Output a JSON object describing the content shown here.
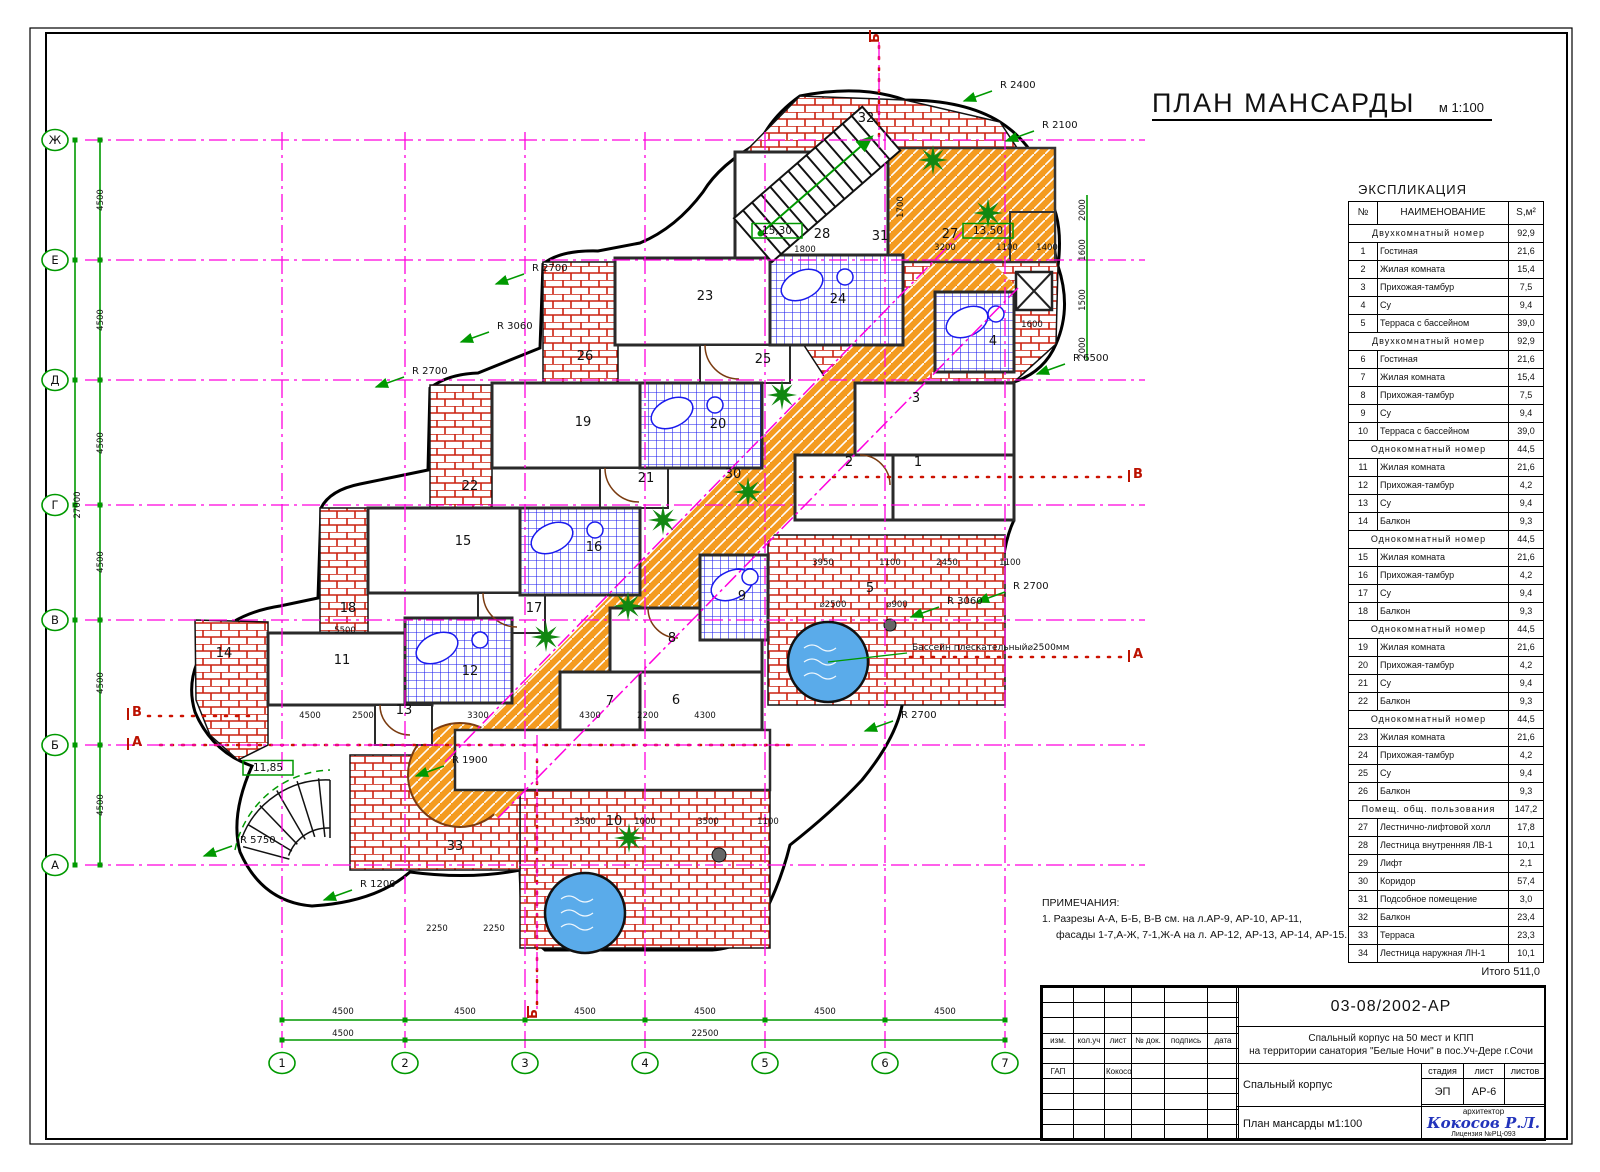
{
  "sheet": {
    "title": "ПЛАН МАНСАРДЫ",
    "scale": "м 1:100"
  },
  "colors": {
    "dimension_green": "#009900",
    "grid_magenta": "#ff00dd",
    "brick_red": "#cc2211",
    "tile_blue": "#1a1aee",
    "corridor_orange": "#f49b20",
    "pool_blue": "#5aabea",
    "section_red": "#bb1100",
    "signature_blue": "#2233bb"
  },
  "explication": {
    "title": "ЭКСПЛИКАЦИЯ",
    "columns": [
      "№",
      "НАИМЕНОВАНИЕ",
      "S,м²"
    ],
    "rows": [
      {
        "type": "group",
        "name": "Двухкомнатный номер",
        "s": "92,9"
      },
      {
        "n": "1",
        "name": "Гостиная",
        "s": "21,6"
      },
      {
        "n": "2",
        "name": "Жилая комната",
        "s": "15,4"
      },
      {
        "n": "3",
        "name": "Прихожая-тамбур",
        "s": "7,5"
      },
      {
        "n": "4",
        "name": "Су",
        "s": "9,4"
      },
      {
        "n": "5",
        "name": "Терраса с бассейном",
        "s": "39,0"
      },
      {
        "type": "group",
        "name": "Двухкомнатный номер",
        "s": "92,9"
      },
      {
        "n": "6",
        "name": "Гостиная",
        "s": "21,6"
      },
      {
        "n": "7",
        "name": "Жилая комната",
        "s": "15,4"
      },
      {
        "n": "8",
        "name": "Прихожая-тамбур",
        "s": "7,5"
      },
      {
        "n": "9",
        "name": "Су",
        "s": "9,4"
      },
      {
        "n": "10",
        "name": "Терраса с бассейном",
        "s": "39,0"
      },
      {
        "type": "group",
        "name": "Однокомнатный номер",
        "s": "44,5"
      },
      {
        "n": "11",
        "name": "Жилая комната",
        "s": "21,6"
      },
      {
        "n": "12",
        "name": "Прихожая-тамбур",
        "s": "4,2"
      },
      {
        "n": "13",
        "name": "Су",
        "s": "9,4"
      },
      {
        "n": "14",
        "name": "Балкон",
        "s": "9,3"
      },
      {
        "type": "group",
        "name": "Однокомнатный номер",
        "s": "44,5"
      },
      {
        "n": "15",
        "name": "Жилая комната",
        "s": "21,6"
      },
      {
        "n": "16",
        "name": "Прихожая-тамбур",
        "s": "4,2"
      },
      {
        "n": "17",
        "name": "Су",
        "s": "9,4"
      },
      {
        "n": "18",
        "name": "Балкон",
        "s": "9,3"
      },
      {
        "type": "group",
        "name": "Однокомнатный номер",
        "s": "44,5"
      },
      {
        "n": "19",
        "name": "Жилая комната",
        "s": "21,6"
      },
      {
        "n": "20",
        "name": "Прихожая-тамбур",
        "s": "4,2"
      },
      {
        "n": "21",
        "name": "Су",
        "s": "9,4"
      },
      {
        "n": "22",
        "name": "Балкон",
        "s": "9,3"
      },
      {
        "type": "group",
        "name": "Однокомнатный номер",
        "s": "44,5"
      },
      {
        "n": "23",
        "name": "Жилая комната",
        "s": "21,6"
      },
      {
        "n": "24",
        "name": "Прихожая-тамбур",
        "s": "4,2"
      },
      {
        "n": "25",
        "name": "Су",
        "s": "9,4"
      },
      {
        "n": "26",
        "name": "Балкон",
        "s": "9,3"
      },
      {
        "type": "group",
        "name": "Помещ. общ. пользования",
        "s": "147,2"
      },
      {
        "n": "27",
        "name": "Лестнично-лифтовой холл",
        "s": "17,8"
      },
      {
        "n": "28",
        "name": "Лестница внутренняя ЛВ-1",
        "s": "10,1"
      },
      {
        "n": "29",
        "name": "Лифт",
        "s": "2,1"
      },
      {
        "n": "30",
        "name": "Коридор",
        "s": "57,4"
      },
      {
        "n": "31",
        "name": "Подсобное помещение",
        "s": "3,0"
      },
      {
        "n": "32",
        "name": "Балкон",
        "s": "23,4"
      },
      {
        "n": "33",
        "name": "Терраса",
        "s": "23,3"
      },
      {
        "n": "34",
        "name": "Лестница наружная ЛН-1",
        "s": "10,1"
      }
    ],
    "total": "Итого 511,0"
  },
  "notes": {
    "title": "ПРИМЕЧАНИЯ:",
    "lines": [
      "1. Разрезы А-А, Б-Б, В-В см. на л.АР-9, АР-10, АР-11,",
      "фасады 1-7,А-Ж, 7-1,Ж-А на л. АР-12, АР-13, АР-14, АР-15."
    ]
  },
  "titleblock": {
    "doc_number": "03-08/2002-АР",
    "project_line1": "Спальный корпус на 50 мест и КПП",
    "project_line2": "на территории санатория \"Белые Ночи\" в пос.Уч-Дере г.Сочи",
    "stamp": {
      "headers": [
        "изм.",
        "кол.уч",
        "лист",
        "№ док.",
        "подпись",
        "дата"
      ],
      "role": "ГАП",
      "name": "Кокосов Р.Л."
    },
    "object": "Спальный корпус",
    "stage_label": "стадия",
    "stage": "ЭП",
    "sheet_label": "лист",
    "sheet": "АР-6",
    "sheets_label": "листов",
    "sheets": "",
    "drawing_title": "План мансарды  м1:100",
    "architect_label": "архитектор",
    "signature": "Кокосов Р.Л.",
    "license": "Лицензия №РЦ-093"
  },
  "plan": {
    "axes_letters": [
      {
        "t": "Ж",
        "y": 140
      },
      {
        "t": "Е",
        "y": 260
      },
      {
        "t": "Д",
        "y": 380
      },
      {
        "t": "Г",
        "y": 505
      },
      {
        "t": "В",
        "y": 620
      },
      {
        "t": "Б",
        "y": 745
      },
      {
        "t": "А",
        "y": 865
      }
    ],
    "axes_numbers": [
      {
        "t": "1",
        "x": 282
      },
      {
        "t": "2",
        "x": 405
      },
      {
        "t": "3",
        "x": 525
      },
      {
        "t": "4",
        "x": 645
      },
      {
        "t": "5",
        "x": 765
      },
      {
        "t": "6",
        "x": 885
      },
      {
        "t": "7",
        "x": 1005
      }
    ],
    "rooms": [
      {
        "t": "32",
        "x": 866,
        "y": 122
      },
      {
        "t": "28",
        "x": 822,
        "y": 238
      },
      {
        "t": "31",
        "x": 880,
        "y": 240
      },
      {
        "t": "27",
        "x": 950,
        "y": 238
      },
      {
        "t": "23",
        "x": 705,
        "y": 300
      },
      {
        "t": "24",
        "x": 838,
        "y": 303
      },
      {
        "t": "25",
        "x": 763,
        "y": 363
      },
      {
        "t": "3",
        "x": 916,
        "y": 402
      },
      {
        "t": "4",
        "x": 993,
        "y": 345
      },
      {
        "t": "2",
        "x": 849,
        "y": 466
      },
      {
        "t": "1",
        "x": 918,
        "y": 466
      },
      {
        "t": "19",
        "x": 583,
        "y": 426
      },
      {
        "t": "20",
        "x": 718,
        "y": 428
      },
      {
        "t": "21",
        "x": 646,
        "y": 482
      },
      {
        "t": "30",
        "x": 733,
        "y": 478
      },
      {
        "t": "26",
        "x": 585,
        "y": 360
      },
      {
        "t": "22",
        "x": 470,
        "y": 490
      },
      {
        "t": "15",
        "x": 463,
        "y": 545
      },
      {
        "t": "16",
        "x": 594,
        "y": 551
      },
      {
        "t": "17",
        "x": 534,
        "y": 612
      },
      {
        "t": "18",
        "x": 348,
        "y": 612
      },
      {
        "t": "5",
        "x": 870,
        "y": 592
      },
      {
        "t": "9",
        "x": 742,
        "y": 600
      },
      {
        "t": "8",
        "x": 672,
        "y": 642
      },
      {
        "t": "6",
        "x": 676,
        "y": 704
      },
      {
        "t": "7",
        "x": 610,
        "y": 705
      },
      {
        "t": "12",
        "x": 470,
        "y": 675
      },
      {
        "t": "11",
        "x": 342,
        "y": 664
      },
      {
        "t": "13",
        "x": 404,
        "y": 714
      },
      {
        "t": "14",
        "x": 224,
        "y": 657
      },
      {
        "t": "10",
        "x": 614,
        "y": 825
      },
      {
        "t": "33",
        "x": 455,
        "y": 850
      }
    ],
    "levels": [
      {
        "t": "15,30",
        "x": 777,
        "y": 234
      },
      {
        "t": "13,50",
        "x": 988,
        "y": 234
      },
      {
        "t": "11,85",
        "x": 268,
        "y": 771
      }
    ],
    "radii": [
      {
        "t": "R 2400",
        "x": 1000,
        "y": 88
      },
      {
        "t": "R 2100",
        "x": 1042,
        "y": 128
      },
      {
        "t": "R 2700",
        "x": 532,
        "y": 271
      },
      {
        "t": "R 3060",
        "x": 497,
        "y": 329
      },
      {
        "t": "R 2700",
        "x": 412,
        "y": 374
      },
      {
        "t": "R 6500",
        "x": 1073,
        "y": 361
      },
      {
        "t": "R 2700",
        "x": 1013,
        "y": 589
      },
      {
        "t": "R 3060",
        "x": 947,
        "y": 604
      },
      {
        "t": "R 2700",
        "x": 901,
        "y": 718
      },
      {
        "t": "R 5750",
        "x": 240,
        "y": 843
      },
      {
        "t": "R 1200",
        "x": 360,
        "y": 887
      },
      {
        "t": "R 1900",
        "x": 452,
        "y": 763
      }
    ],
    "dims": [
      {
        "t": "4500",
        "x": 343,
        "y": 1014
      },
      {
        "t": "4500",
        "x": 465,
        "y": 1014
      },
      {
        "t": "4500",
        "x": 585,
        "y": 1014
      },
      {
        "t": "4500",
        "x": 705,
        "y": 1014
      },
      {
        "t": "4500",
        "x": 825,
        "y": 1014
      },
      {
        "t": "4500",
        "x": 945,
        "y": 1014
      },
      {
        "t": "4500",
        "x": 343,
        "y": 1036
      },
      {
        "t": "22500",
        "x": 705,
        "y": 1036
      },
      {
        "t": "4500",
        "x": 103,
        "y": 200,
        "r": -90
      },
      {
        "t": "4500",
        "x": 103,
        "y": 320,
        "r": -90
      },
      {
        "t": "4500",
        "x": 103,
        "y": 443,
        "r": -90
      },
      {
        "t": "4500",
        "x": 103,
        "y": 562,
        "r": -90
      },
      {
        "t": "4500",
        "x": 103,
        "y": 683,
        "r": -90
      },
      {
        "t": "4500",
        "x": 103,
        "y": 805,
        "r": -90
      },
      {
        "t": "27000",
        "x": 80,
        "y": 505,
        "r": -90
      },
      {
        "t": "4500",
        "x": 310,
        "y": 718
      },
      {
        "t": "2500",
        "x": 363,
        "y": 718
      },
      {
        "t": "3300",
        "x": 478,
        "y": 718
      },
      {
        "t": "4300",
        "x": 590,
        "y": 718
      },
      {
        "t": "2200",
        "x": 648,
        "y": 718
      },
      {
        "t": "4300",
        "x": 705,
        "y": 718
      },
      {
        "t": "3500",
        "x": 585,
        "y": 824
      },
      {
        "t": "1000",
        "x": 645,
        "y": 824
      },
      {
        "t": "3500",
        "x": 708,
        "y": 824
      },
      {
        "t": "1100",
        "x": 768,
        "y": 824
      },
      {
        "t": "2250",
        "x": 437,
        "y": 931
      },
      {
        "t": "2250",
        "x": 494,
        "y": 931
      },
      {
        "t": "5500",
        "x": 345,
        "y": 633
      },
      {
        "t": "3950",
        "x": 823,
        "y": 565
      },
      {
        "t": "1100",
        "x": 890,
        "y": 565
      },
      {
        "t": "2450",
        "x": 947,
        "y": 565
      },
      {
        "t": "1100",
        "x": 1010,
        "y": 565
      },
      {
        "t": "⌀2500",
        "x": 833,
        "y": 607
      },
      {
        "t": "⌀900",
        "x": 897,
        "y": 607
      },
      {
        "t": "1800",
        "x": 805,
        "y": 252
      },
      {
        "t": "3200",
        "x": 945,
        "y": 250
      },
      {
        "t": "1100",
        "x": 1007,
        "y": 250
      },
      {
        "t": "1400",
        "x": 1047,
        "y": 250
      },
      {
        "t": "1600",
        "x": 1032,
        "y": 327
      },
      {
        "t": "1700",
        "x": 903,
        "y": 207,
        "r": -90
      },
      {
        "t": "2000",
        "x": 1085,
        "y": 210,
        "r": -90
      },
      {
        "t": "1600",
        "x": 1085,
        "y": 250,
        "r": -90
      },
      {
        "t": "1500",
        "x": 1085,
        "y": 300,
        "r": -90
      },
      {
        "t": "2000",
        "x": 1085,
        "y": 348,
        "r": -90
      }
    ],
    "sections": [
      {
        "t": "В",
        "x": 137,
        "y": 716
      },
      {
        "t": "А",
        "x": 137,
        "y": 746
      },
      {
        "t": "В",
        "x": 1138,
        "y": 478
      },
      {
        "t": "А",
        "x": 1138,
        "y": 658
      },
      {
        "t": "Б",
        "x": 879,
        "y": 38,
        "r": -90
      },
      {
        "t": "Б",
        "x": 537,
        "y": 1014,
        "r": -90
      }
    ],
    "pool_label": {
      "t": "Бассейн плескательный⌀2500мм",
      "x": 912,
      "y": 650
    },
    "trees": [
      [
        933,
        160
      ],
      [
        988,
        213
      ],
      [
        782,
        395
      ],
      [
        748,
        492
      ],
      [
        663,
        520
      ],
      [
        546,
        637
      ],
      [
        628,
        606
      ],
      [
        629,
        838
      ]
    ]
  }
}
